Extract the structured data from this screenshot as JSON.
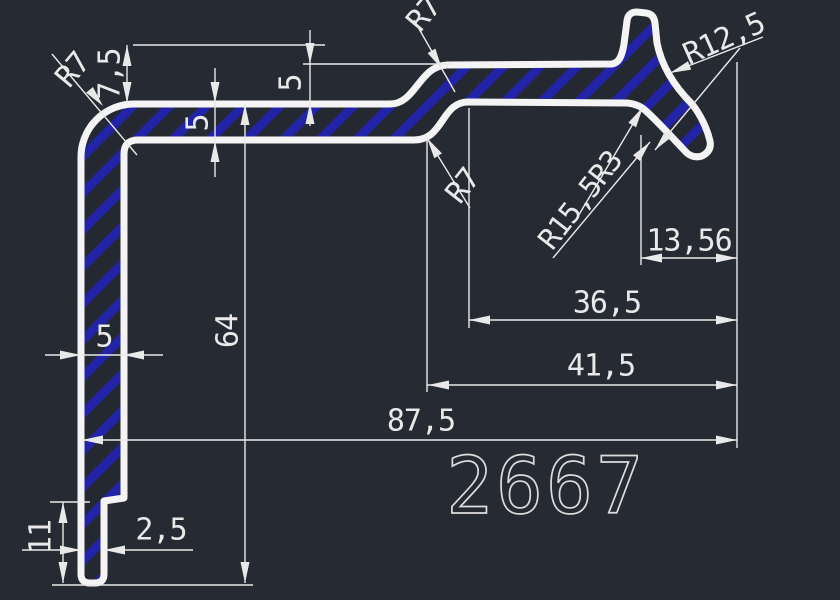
{
  "drawing": {
    "part_number": "2667",
    "colors": {
      "background": "#262b33",
      "outline": "#f4f4f4",
      "hatch_blue": "#2323a8",
      "dimension": "#e9e9e9"
    },
    "radii": {
      "r7_top_left": "R7",
      "r7_top_middle": "R7",
      "r7_middle": "R7",
      "r15_5_r3": "R15,5R3",
      "r12_5": "R12,5"
    },
    "dims": {
      "d7_5": "7,5",
      "d5_rise": "5",
      "d5_wall": "5",
      "d5_leg": "5",
      "d64": "64",
      "d11": "11",
      "d2_5": "2,5",
      "d13_56": "13,56",
      "d36_5": "36,5",
      "d41_5": "41,5",
      "d87_5": "87,5"
    }
  }
}
